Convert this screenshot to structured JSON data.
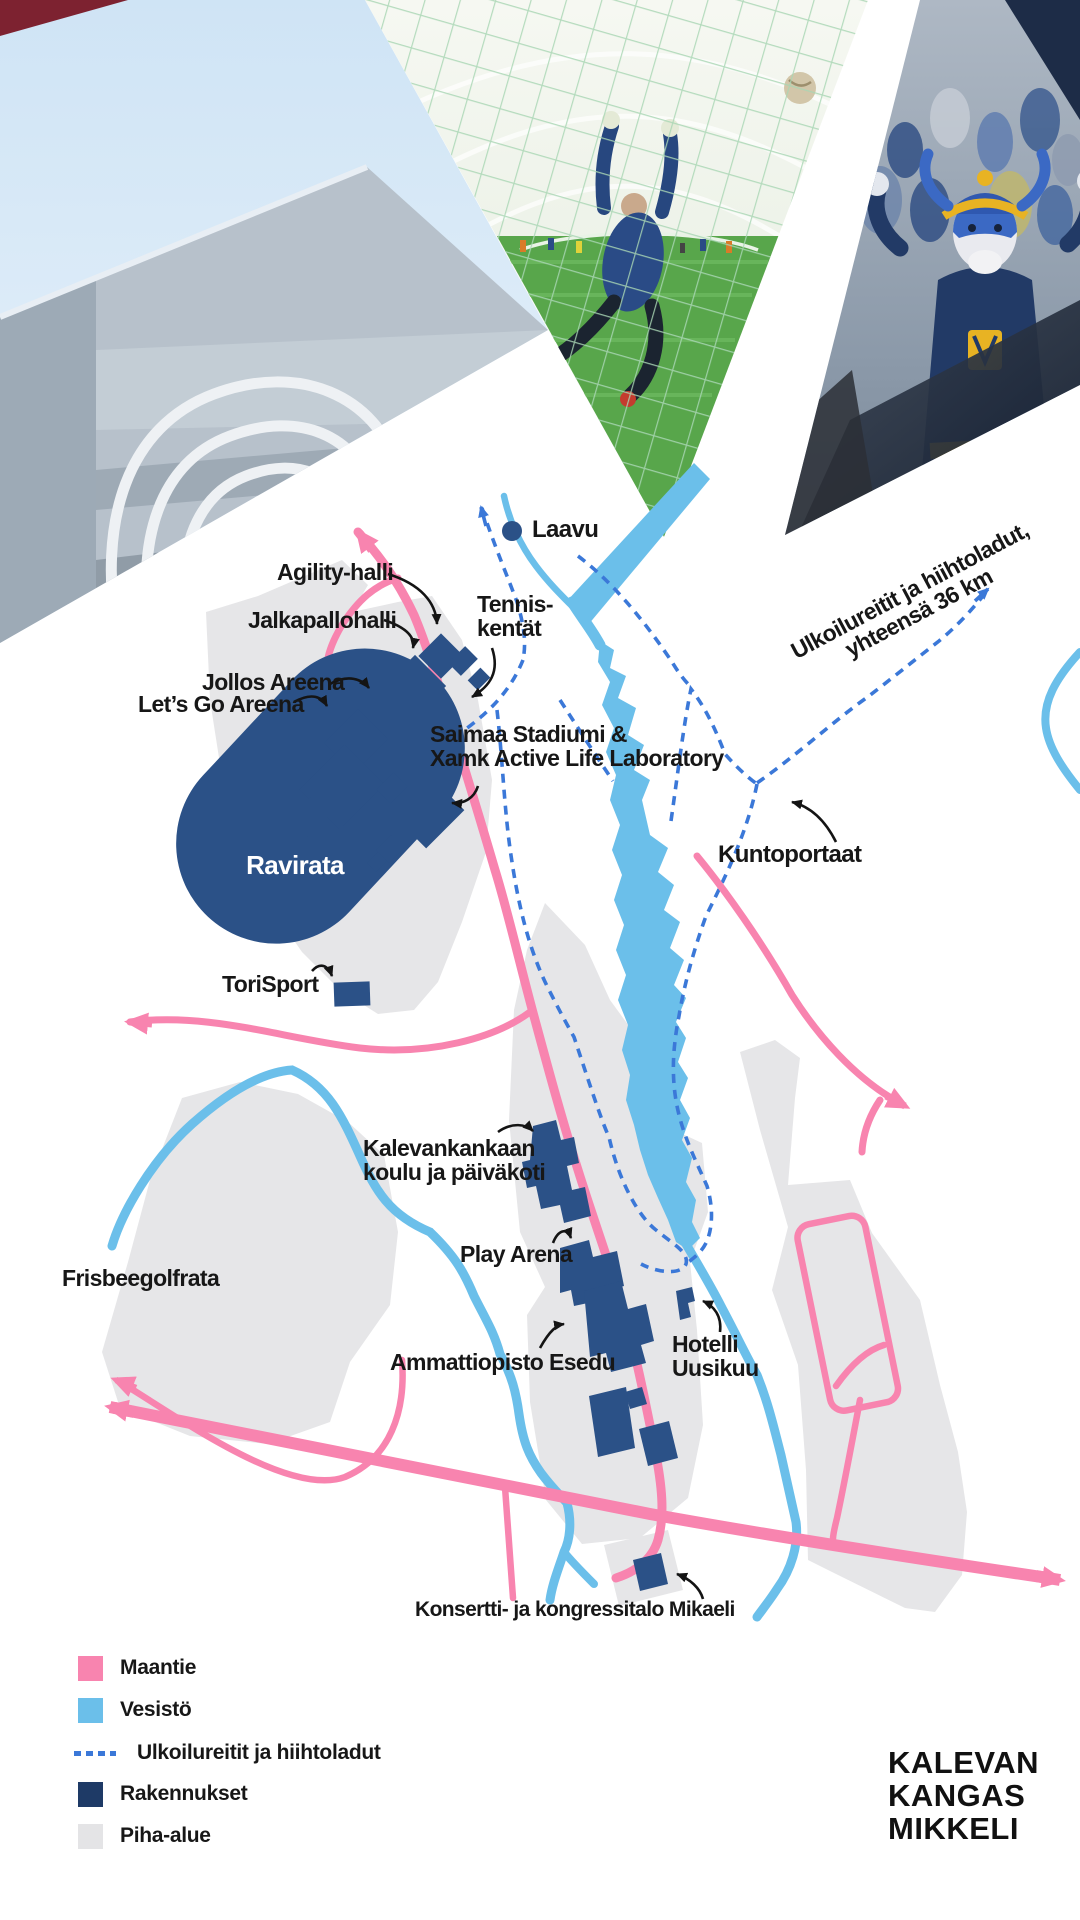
{
  "title": "Kalevankangas Mikkeli area map",
  "labels": {
    "laavu": "Laavu",
    "agility": "Agility-halli",
    "jalkapallohalli": "Jalkapallohalli",
    "tennis1": "Tennis-",
    "tennis2": "kentät",
    "jollos": "Jollos Areena",
    "letsgo": "Let’s Go Areena",
    "saimaa1": "Saimaa Stadiumi &",
    "saimaa2": "Xamk Active Life Laboratory",
    "ravirata": "Ravirata",
    "torisport": "ToriSport",
    "kuntoportaat": "Kuntoportaat",
    "trails1": "Ulkoilureitit ja hiihtoladut,",
    "trails2": "yhteensä 36 km",
    "frisbee": "Frisbeegolfrata",
    "koulu1": "Kalevankankaan",
    "koulu2": "koulu ja päiväkoti",
    "playarena": "Play Arena",
    "esedu": "Ammattiopisto Esedu",
    "hotelli1": "Hotelli",
    "hotelli2": "Uusikuu",
    "mikaeli": "Konsertti- ja kongressitalo Mikaeli"
  },
  "legend": {
    "items": [
      {
        "label": "Maantie",
        "type": "road",
        "color": "#F884AF"
      },
      {
        "label": "Vesistö",
        "type": "water",
        "color": "#6BBFEA"
      },
      {
        "label": "Ulkoilureitit ja hiihtoladut",
        "type": "trail",
        "color": "#3B78D8"
      },
      {
        "label": "Rakennukset",
        "type": "buildings",
        "color": "#1E3A66"
      },
      {
        "label": "Piha-alue",
        "type": "yard",
        "color": "#E4E4E6"
      }
    ]
  },
  "logo": {
    "line1": "KALEVAN",
    "line2": "KANGAS",
    "line3": "MIKKELI"
  },
  "photos": [
    {
      "name": "sports-hall-facade"
    },
    {
      "name": "indoor-football-goalkeeper"
    },
    {
      "name": "mascot-and-crowd"
    }
  ],
  "colors": {
    "road": "#F884AF",
    "water": "#6BBFEA",
    "trail": "#3B78D8",
    "building": "#2B5187",
    "yard": "#E6E6E8",
    "label": "#171717"
  }
}
